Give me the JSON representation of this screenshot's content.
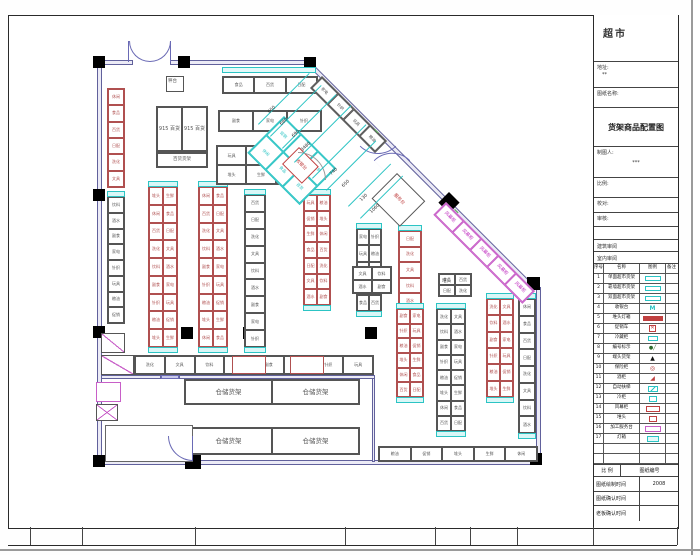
{
  "title_block": {
    "store_name": "超市",
    "address_label": "地址:",
    "address_value": "**",
    "sheet_name_label": "图纸名称:",
    "drawing_title": "货架商品配置图",
    "drafter_label": "制图人:",
    "drafter_value": "***",
    "scale_label": "比例:",
    "check_label": "校对:",
    "audit_label": "审核:",
    "arch_review": "建筑审阅",
    "interior_review": "室内审阅",
    "legend_headers": [
      "序号",
      "名称",
      "图例",
      "备注"
    ],
    "legend_rows": [
      {
        "no": "1",
        "name": "单面超市货架",
        "swatch": "teal-rect"
      },
      {
        "no": "2",
        "name": "靠墙超市货架",
        "swatch": "teal-rect"
      },
      {
        "no": "3",
        "name": "双面超市货架",
        "swatch": "teal-rect"
      },
      {
        "no": "4",
        "name": "收银台",
        "swatch": "teal-m"
      },
      {
        "no": "5",
        "name": "堆头灯箱",
        "swatch": "red-bar"
      },
      {
        "no": "6",
        "name": "促销车",
        "swatch": "red-x"
      },
      {
        "no": "7",
        "name": "冷藏柜",
        "swatch": "teal-sm"
      },
      {
        "no": "8",
        "name": "编号标示",
        "swatch": "dot"
      },
      {
        "no": "9",
        "name": "端头货架",
        "swatch": "tri"
      },
      {
        "no": "10",
        "name": "保险柜",
        "swatch": "circ"
      },
      {
        "no": "11",
        "name": "酒柜",
        "swatch": "wedge"
      },
      {
        "no": "12",
        "name": "自动扶梯",
        "swatch": "teal-esc"
      },
      {
        "no": "13",
        "name": "冷柜",
        "swatch": "teal-box"
      },
      {
        "no": "14",
        "name": "风幕柜",
        "swatch": "red-box"
      },
      {
        "no": "15",
        "name": "堆头",
        "swatch": "red-sm"
      },
      {
        "no": "16",
        "name": "加工服务台",
        "swatch": "mag-box"
      },
      {
        "no": "17",
        "name": "灯箱",
        "swatch": "cyan-box"
      },
      {
        "no": "",
        "name": "",
        "swatch": ""
      },
      {
        "no": "",
        "name": "",
        "swatch": ""
      }
    ],
    "footer": {
      "scale_label": "比 例",
      "sheet_no_label": "图纸编号",
      "rows": [
        {
          "label": "图纸绘制时间",
          "value": "2008"
        },
        {
          "label": "图纸确认时间",
          "value": ""
        },
        {
          "label": "老板确认时间",
          "value": ""
        }
      ]
    }
  },
  "plan": {
    "colors": {
      "red": "#b05050",
      "dark": "#555555",
      "cyan": "#2cc4c4",
      "mag": "#c85fc8",
      "door": "#6a6ab5"
    },
    "cell_labels": [
      "休闲",
      "食品",
      "百货",
      "日配",
      "洗化",
      "文具",
      "饮料",
      "酒水",
      "副食",
      "家电",
      "针织",
      "玩具",
      "粮油",
      "促销",
      "堆头",
      "生鲜"
    ],
    "walls": [
      {
        "x": 97,
        "y": 60,
        "w": 36,
        "h": 5
      },
      {
        "x": 170,
        "y": 60,
        "w": 141,
        "h": 5
      },
      {
        "x": 97,
        "y": 60,
        "w": 5,
        "h": 405
      },
      {
        "x": 97,
        "y": 460,
        "w": 444,
        "h": 5
      },
      {
        "x": 536,
        "y": 287,
        "w": 5,
        "h": 177
      },
      {
        "x": 101,
        "y": 375,
        "w": 60,
        "h": 4
      },
      {
        "x": 179,
        "y": 375,
        "w": 196,
        "h": 4
      },
      {
        "x": 372,
        "y": 378,
        "w": 3,
        "h": 84
      },
      {
        "x": 105,
        "y": 425,
        "w": 88,
        "h": 3
      },
      {
        "x": 190,
        "y": 425,
        "w": 3,
        "h": 14
      },
      {
        "x": 309,
        "y": 60,
        "w": 322,
        "h": 5,
        "rot": 45
      }
    ],
    "columns": [
      {
        "x": 93,
        "y": 56,
        "w": 12,
        "h": 12
      },
      {
        "x": 178,
        "y": 56,
        "w": 12,
        "h": 12
      },
      {
        "x": 304,
        "y": 57,
        "w": 12,
        "h": 12
      },
      {
        "x": 93,
        "y": 189,
        "w": 12,
        "h": 12
      },
      {
        "x": 93,
        "y": 326,
        "w": 12,
        "h": 12
      },
      {
        "x": 93,
        "y": 455,
        "w": 12,
        "h": 12
      },
      {
        "x": 181,
        "y": 327,
        "w": 12,
        "h": 12
      },
      {
        "x": 243,
        "y": 327,
        "w": 12,
        "h": 12
      },
      {
        "x": 365,
        "y": 327,
        "w": 12,
        "h": 12
      },
      {
        "x": 530,
        "y": 453,
        "w": 12,
        "h": 12
      },
      {
        "x": 527,
        "y": 277,
        "w": 13,
        "h": 13
      },
      {
        "x": 449,
        "y": 192,
        "w": 15,
        "h": 15,
        "rot": 45
      },
      {
        "x": 185,
        "y": 443,
        "w": 16,
        "h": 26
      },
      {
        "x": 443,
        "y": 326,
        "w": 12,
        "h": 86
      }
    ],
    "strips": [
      {
        "x": 222,
        "y": 67,
        "w": 94,
        "h": 6,
        "c": "#2cc4c4",
        "f": "#e3fafa"
      },
      {
        "x": 161,
        "y": 375,
        "w": 18,
        "h": 4,
        "c": "#6a6ab5",
        "f": "#c9c9ea"
      }
    ],
    "grids": [
      {
        "x": 107,
        "y": 88,
        "w": 18,
        "h": 100,
        "c": 1,
        "r": 6,
        "e": "#b05050"
      },
      {
        "x": 107,
        "y": 196,
        "w": 18,
        "h": 128,
        "c": 1,
        "r": 8,
        "e": "#555555",
        "capT": 1
      },
      {
        "x": 148,
        "y": 186,
        "w": 30,
        "h": 162,
        "c": 2,
        "r": 9,
        "e": "#b05050",
        "capT": 1,
        "capB": 1
      },
      {
        "x": 198,
        "y": 186,
        "w": 30,
        "h": 162,
        "c": 2,
        "r": 9,
        "e": "#b05050",
        "capT": 1,
        "capB": 1
      },
      {
        "x": 244,
        "y": 194,
        "w": 22,
        "h": 154,
        "c": 1,
        "r": 9,
        "e": "#555555",
        "capT": 1,
        "capB": 1
      },
      {
        "x": 303,
        "y": 194,
        "w": 28,
        "h": 112,
        "c": 2,
        "r": 7,
        "e": "#b05050",
        "capT": 1,
        "capB": 1
      },
      {
        "x": 356,
        "y": 228,
        "w": 26,
        "h": 84,
        "c": 2,
        "r": 5,
        "e": "#555555",
        "capT": 1,
        "capB": 1
      },
      {
        "x": 398,
        "y": 230,
        "w": 24,
        "h": 80,
        "c": 1,
        "r": 5,
        "e": "#b05050",
        "capT": 1,
        "capB": 1
      },
      {
        "x": 396,
        "y": 308,
        "w": 28,
        "h": 90,
        "c": 2,
        "r": 6,
        "e": "#b05050",
        "capT": 1,
        "capB": 1
      },
      {
        "x": 436,
        "y": 308,
        "w": 30,
        "h": 124,
        "c": 2,
        "r": 8,
        "e": "#555555",
        "capT": 1,
        "capB": 1
      },
      {
        "x": 486,
        "y": 298,
        "w": 28,
        "h": 100,
        "c": 2,
        "r": 6,
        "e": "#b05050",
        "capT": 1,
        "capB": 1
      },
      {
        "x": 518,
        "y": 298,
        "w": 18,
        "h": 136,
        "c": 1,
        "r": 8,
        "e": "#555555",
        "capT": 1,
        "capB": 1
      },
      {
        "x": 218,
        "y": 110,
        "w": 104,
        "h": 22,
        "c": 3,
        "r": 1,
        "e": "#555555"
      },
      {
        "x": 216,
        "y": 145,
        "w": 90,
        "h": 40,
        "c": 3,
        "r": 2,
        "e": "#555555"
      },
      {
        "x": 222,
        "y": 76,
        "w": 96,
        "h": 18,
        "c": 3,
        "r": 1,
        "e": "#555555"
      },
      {
        "x": 156,
        "y": 106,
        "w": 52,
        "h": 46,
        "c": 2,
        "r": 1,
        "e": "#555555",
        "labels": [
          "915 百货",
          "915 百货"
        ],
        "fs": 5
      },
      {
        "x": 156,
        "y": 152,
        "w": 52,
        "h": 16,
        "c": 1,
        "r": 1,
        "e": "#555555",
        "labels": [
          "百货货架"
        ],
        "fs": 4.5
      },
      {
        "x": 134,
        "y": 355,
        "w": 240,
        "h": 20,
        "c": 8,
        "r": 1,
        "e": "#555555"
      },
      {
        "x": 184,
        "y": 379,
        "w": 176,
        "h": 26,
        "c": 2,
        "r": 1,
        "e": "#555555",
        "labels": [
          "仓储货架",
          "仓储货架"
        ],
        "fs": 6.5
      },
      {
        "x": 184,
        "y": 427,
        "w": 176,
        "h": 28,
        "c": 2,
        "r": 1,
        "e": "#555555",
        "labels": [
          "仓储货架",
          "仓储货架"
        ],
        "fs": 6.5
      },
      {
        "x": 378,
        "y": 446,
        "w": 160,
        "h": 16,
        "c": 5,
        "r": 1,
        "e": "#555555"
      },
      {
        "x": 438,
        "y": 273,
        "w": 34,
        "h": 24,
        "c": 2,
        "r": 2,
        "e": "#555555"
      },
      {
        "x": 352,
        "y": 266,
        "w": 40,
        "h": 28,
        "c": 2,
        "r": 2,
        "e": "#555555"
      },
      {
        "x": 322,
        "y": 76,
        "w": 92,
        "h": 17,
        "c": 4,
        "r": 1,
        "e": "#555555",
        "rot": 45
      },
      {
        "x": 446,
        "y": 202,
        "w": 126,
        "h": 18,
        "c": 5,
        "r": 1,
        "e": "#c85fc8",
        "rot": 45,
        "labels": [
          "风幕柜",
          "风幕柜",
          "风幕柜",
          "风幕柜",
          "风幕柜"
        ],
        "fs": 4.5,
        "lc": "#c030c0"
      },
      {
        "x": 284,
        "y": 116,
        "w": 74,
        "h": 52,
        "c": 3,
        "r": 2,
        "e": "#2cc4c4",
        "rot": 45
      }
    ],
    "boxes": [
      {
        "x": 166,
        "y": 76,
        "w": 18,
        "h": 16,
        "e": "#555555"
      },
      {
        "x": 299,
        "y": 147,
        "w": 28,
        "h": 24,
        "e": "#c04040",
        "rot": 45,
        "label": "收银台",
        "lc": "#c04040",
        "fs": 4.5
      },
      {
        "x": 397,
        "y": 173,
        "w": 40,
        "h": 36,
        "e": "#555555",
        "rot": 45,
        "label": "服务台",
        "lc": "#c04040",
        "fs": 4.5
      },
      {
        "x": 101,
        "y": 333,
        "w": 24,
        "h": 20,
        "e": "#555555",
        "diag": 1
      },
      {
        "x": 101,
        "y": 355,
        "w": 33,
        "h": 20,
        "e": "#555555",
        "diag": 1
      },
      {
        "x": 96,
        "y": 382,
        "w": 25,
        "h": 20,
        "e": "#c85fc8"
      },
      {
        "x": 96,
        "y": 404,
        "w": 22,
        "h": 17,
        "e": "#555555",
        "diag": 1,
        "diag2": 1
      },
      {
        "x": 232,
        "y": 356,
        "w": 34,
        "h": 18,
        "e": "#b05050"
      },
      {
        "x": 290,
        "y": 356,
        "w": 34,
        "h": 18,
        "e": "#b05050"
      },
      {
        "x": 105,
        "y": 425,
        "w": 88,
        "h": 37,
        "e": "#666666"
      }
    ],
    "arcs": [
      {
        "x": 129,
        "y": 41,
        "r": 21,
        "q": "bl",
        "c": "#6a6ab5"
      },
      {
        "x": 150,
        "y": 41,
        "r": 21,
        "q": "br",
        "c": "#6a6ab5"
      },
      {
        "x": 378,
        "y": 128,
        "r": 26,
        "q": "br",
        "c": "#6a6ab5",
        "rot": 45
      },
      {
        "x": 392,
        "y": 142,
        "r": 26,
        "q": "tl",
        "c": "#6a6ab5",
        "rot": 45
      },
      {
        "x": 168,
        "y": 436,
        "r": 25,
        "q": "bl",
        "c": "#6a6ab5"
      },
      {
        "x": 298,
        "y": 152,
        "r": 28,
        "q": "tr",
        "c": "#9a9a9a"
      }
    ],
    "lines": [
      {
        "x": 129,
        "y": 41,
        "len": 21,
        "rot": 90,
        "c": "#6a6ab5"
      },
      {
        "x": 171,
        "y": 41,
        "len": 21,
        "rot": 90,
        "c": "#6a6ab5"
      },
      {
        "x": 193,
        "y": 436,
        "len": 25,
        "rot": 90,
        "c": "#6a6ab5"
      },
      {
        "x": 258,
        "y": 124,
        "len": 72,
        "rot": -45,
        "c": "#2cc4c4"
      },
      {
        "x": 270,
        "y": 136,
        "len": 72,
        "rot": -45,
        "c": "#2cc4c4"
      },
      {
        "x": 282,
        "y": 148,
        "len": 76,
        "rot": -45,
        "c": "#2cc4c4"
      },
      {
        "x": 294,
        "y": 162,
        "len": 80,
        "rot": -45,
        "c": "#2cc4c4"
      },
      {
        "x": 312,
        "y": 178,
        "len": 76,
        "rot": -45,
        "c": "#2cc4c4"
      },
      {
        "x": 326,
        "y": 190,
        "len": 70,
        "rot": -45,
        "c": "#2cc4c4"
      },
      {
        "x": 348,
        "y": 206,
        "len": 60,
        "rot": -45,
        "c": "#2cc4c4"
      },
      {
        "x": 360,
        "y": 218,
        "len": 60,
        "rot": -45,
        "c": "#2cc4c4"
      },
      {
        "x": 375,
        "y": 129,
        "len": 5,
        "rot": 45,
        "c": "#55aa55"
      },
      {
        "x": 455,
        "y": 209,
        "len": 5,
        "rot": 45,
        "c": "#55aa55"
      }
    ],
    "dims": [
      {
        "t": "650",
        "x": 268,
        "y": 112
      },
      {
        "t": "680",
        "x": 280,
        "y": 124
      },
      {
        "t": "690",
        "x": 292,
        "y": 136
      },
      {
        "t": "3480",
        "x": 301,
        "y": 150
      },
      {
        "t": "740",
        "x": 330,
        "y": 174
      },
      {
        "t": "650",
        "x": 342,
        "y": 186
      },
      {
        "t": "130",
        "x": 360,
        "y": 200
      },
      {
        "t": "1060",
        "x": 370,
        "y": 212
      }
    ],
    "texts": [
      {
        "t": "秤台",
        "x": 168,
        "y": 80,
        "c": "#555555",
        "fs": 4.5
      },
      {
        "t": "堆头",
        "x": 442,
        "y": 280,
        "c": "#555555",
        "fs": 4.5
      }
    ],
    "bottom_ticks": [
      30,
      82,
      195,
      345,
      435,
      470,
      517,
      593,
      677
    ]
  }
}
